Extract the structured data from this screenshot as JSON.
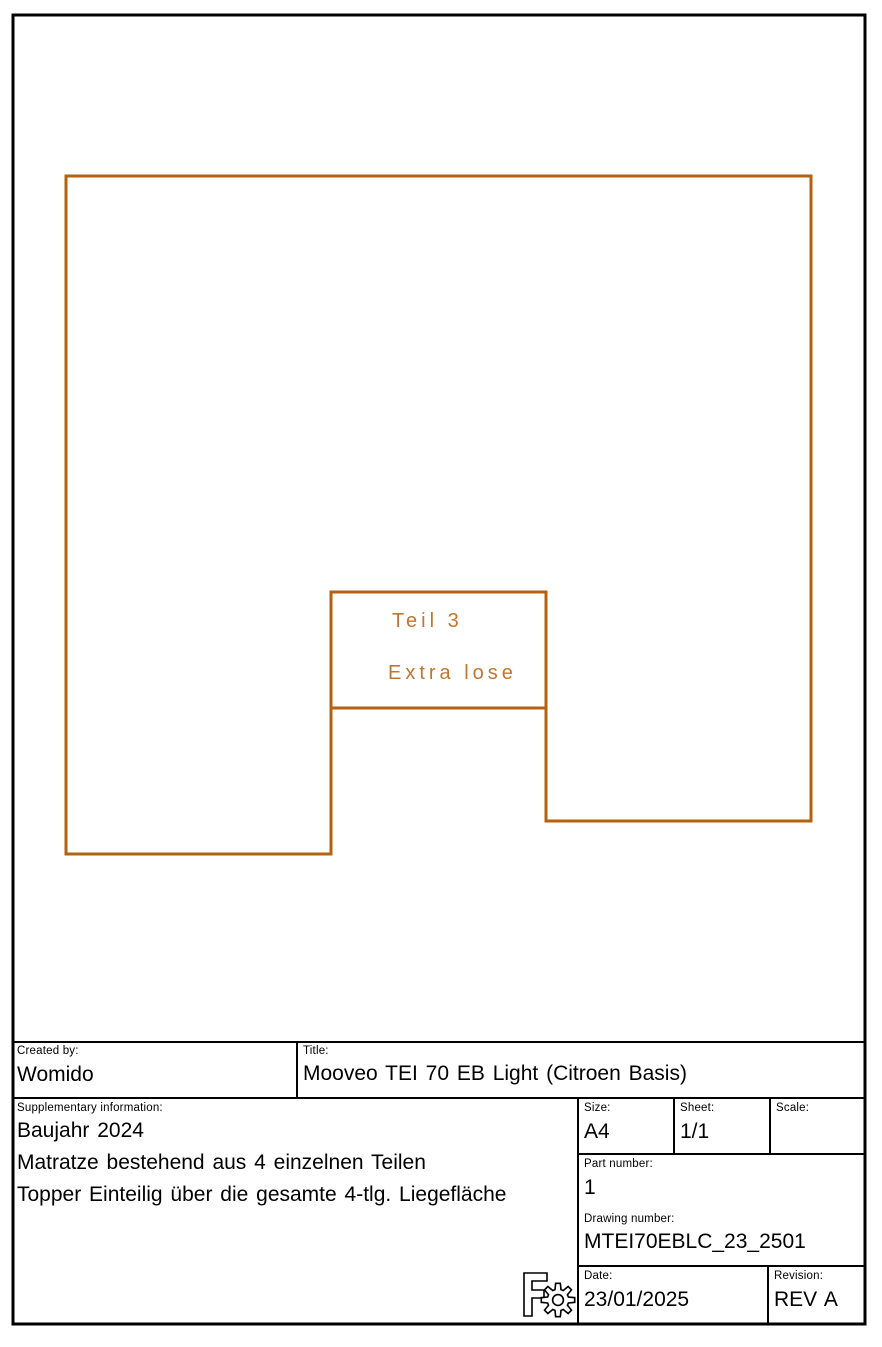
{
  "colors": {
    "drawing_accent": "#b4620e",
    "annotation_text": "#c0762f",
    "line_black": "#000000",
    "page_background": "#ffffff"
  },
  "drawing": {
    "part_label": "Teil 3",
    "part_note": "Extra lose"
  },
  "title_block": {
    "created_by": {
      "label": "Created by:",
      "value": "Womido"
    },
    "title": {
      "label": "Title:",
      "value": "Mooveo TEI 70 EB Light (Citroen Basis)"
    },
    "supplementary": {
      "label": "Supplementary information:",
      "lines": [
        "Baujahr 2024",
        "Matratze bestehend aus 4 einzelnen Teilen",
        "Topper Einteilig über die gesamte 4-tlg. Liegefläche"
      ]
    },
    "size": {
      "label": "Size:",
      "value": "A4"
    },
    "sheet": {
      "label": "Sheet:",
      "value": "1/1"
    },
    "scale": {
      "label": "Scale:",
      "value": ""
    },
    "part_number": {
      "label": "Part number:",
      "value": "1"
    },
    "drawing_number": {
      "label": "Drawing number:",
      "value": "MTEI70EBLC_23_2501"
    },
    "date": {
      "label": "Date:",
      "value": "23/01/2025"
    },
    "revision": {
      "label": "Revision:",
      "value": "REV A"
    }
  },
  "logo": {
    "name": "FreeCAD"
  }
}
